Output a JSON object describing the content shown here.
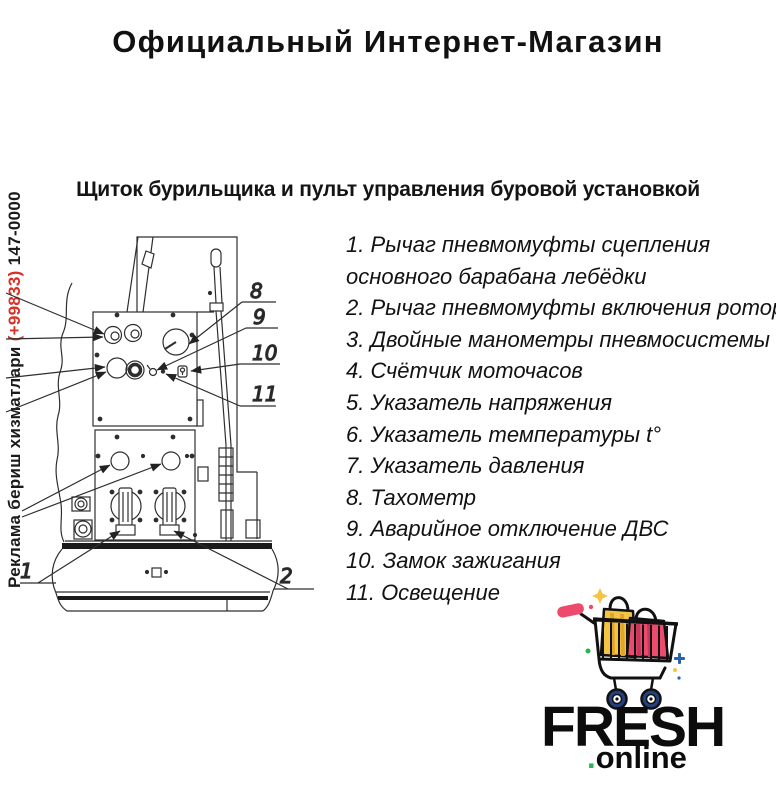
{
  "colors": {
    "ink": "#161616",
    "red": "#d93025",
    "yellow": "#f4c544",
    "yellow-dark": "#e0a62b",
    "pink": "#ec4b6d",
    "pink-dark": "#c9375c",
    "blue": "#2a62ad",
    "navy": "#24407e",
    "green": "#27b74d"
  },
  "header": {
    "title": "Официальный Интернет-Магазин"
  },
  "ad_sidebar": {
    "prefix": "Реклама бериш хизматлари ",
    "phone_code": "(+99833)",
    "phone_rest": " 147-0000"
  },
  "section": {
    "heading": "Щиток бурильщика и пульт управления буровой установкой"
  },
  "diagram": {
    "callouts": {
      "c1": "1",
      "c2": "2",
      "c8": "8",
      "c9": "9",
      "c10": "10",
      "c11": "11"
    }
  },
  "parts_list": {
    "items": [
      "1. Рычаг пневмомуфты сцепления\nосновного барабана лебёдки",
      "2. Рычаг пневмомуфты включения ротора",
      "3. Двойные манометры пневмосистемы",
      "4. Счётчик моточасов",
      "5. Указатель напряжения",
      "6. Указатель температуры t°",
      "7. Указатель давления",
      "8. Тахометр",
      "9. Аварийное отключение ДВС",
      "10. Замок зажигания",
      "11. Освещение"
    ]
  },
  "logo": {
    "brand": "FRESH",
    "dot": ".",
    "suffix": "online"
  }
}
